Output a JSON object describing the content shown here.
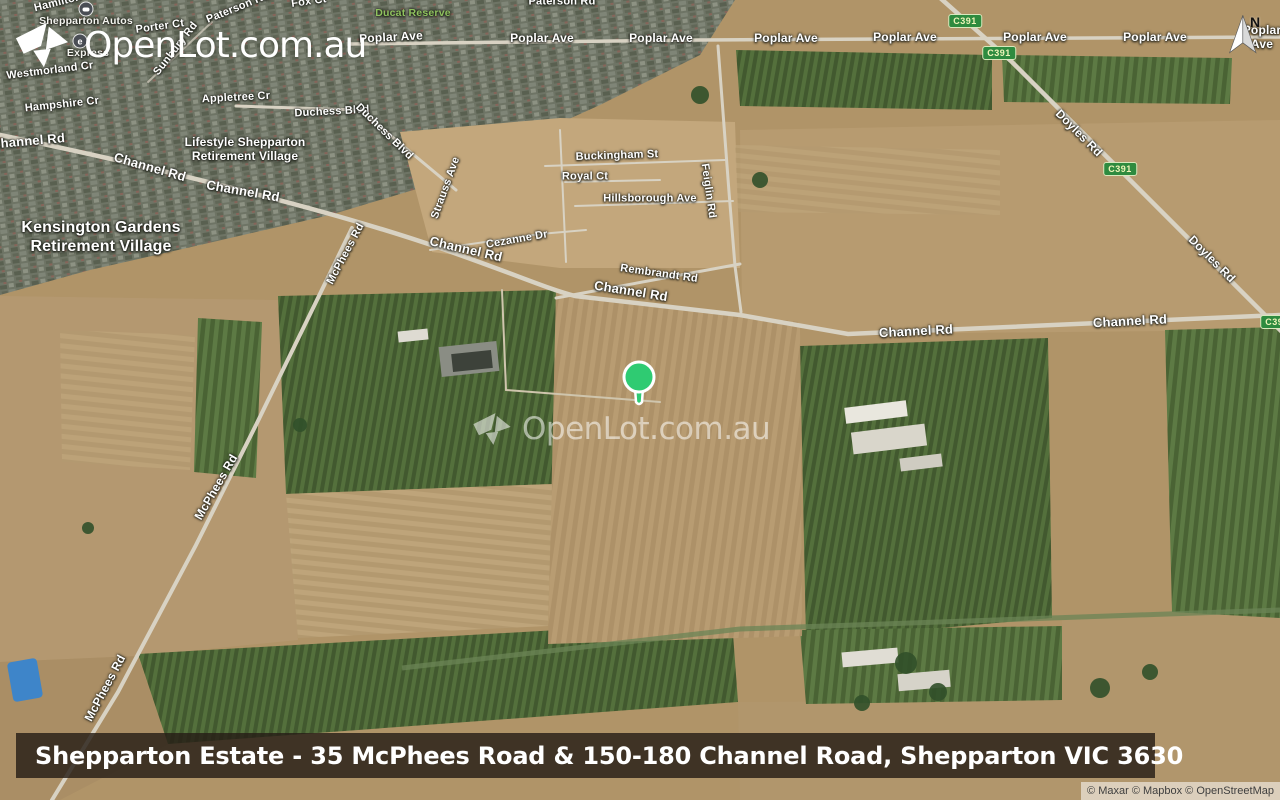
{
  "colors": {
    "marker": "#2fcb72",
    "shield_bg": "#2e8b3f",
    "shield_text": "#eef4b8",
    "park_label": "#8fc25e",
    "banner_bg": "rgba(38,29,22,0.82)"
  },
  "branding": {
    "logo_text": "OpenLot.com.au",
    "watermark_text": "OpenLot.com.au"
  },
  "compass": {
    "label": "N"
  },
  "banner": {
    "title": "Shepparton Estate - 35 McPhees Road & 150-180 Channel Road, Shepparton VIC 3630"
  },
  "attribution": {
    "text": "© Maxar © Mapbox © OpenStreetMap"
  },
  "map": {
    "labels": [
      {
        "t": "Hamilton",
        "x": 58,
        "y": 3,
        "r": -14,
        "s": 11
      },
      {
        "t": "Shepparton Autos",
        "x": 86,
        "y": 21,
        "r": 0,
        "s": 10.5,
        "k": "poi"
      },
      {
        "t": "Porter Ct",
        "x": 160,
        "y": 27,
        "r": -8,
        "s": 11
      },
      {
        "t": "Paterson Rd",
        "x": 238,
        "y": 8,
        "r": -22,
        "s": 11
      },
      {
        "t": "Fox Ct",
        "x": 309,
        "y": 2,
        "r": -8,
        "s": 11
      },
      {
        "t": "Ducat Reserve",
        "x": 413,
        "y": 13,
        "r": 0,
        "s": 10.5,
        "k": "park"
      },
      {
        "t": "Paterson Rd",
        "x": 562,
        "y": 2,
        "r": 0,
        "s": 11
      },
      {
        "t": "Express",
        "x": 88,
        "y": 53,
        "r": 0,
        "s": 10.5,
        "k": "poi"
      },
      {
        "t": "Sunbury Rd",
        "x": 176,
        "y": 49,
        "r": -52,
        "s": 11
      },
      {
        "t": "Westmorland Cr",
        "x": 50,
        "y": 71,
        "r": -7,
        "s": 11
      },
      {
        "t": "Hampshire Cr",
        "x": 62,
        "y": 105,
        "r": -6,
        "s": 11
      },
      {
        "t": "Appletree Cr",
        "x": 236,
        "y": 98,
        "r": -3,
        "s": 11
      },
      {
        "t": "Duchess Blvd",
        "x": 332,
        "y": 112,
        "r": -3,
        "s": 11
      },
      {
        "t": "Duchess Blvd",
        "x": 384,
        "y": 132,
        "r": 44,
        "s": 11
      },
      {
        "t": "Channel Rd",
        "x": 28,
        "y": 141,
        "r": -5,
        "s": 13
      },
      {
        "t": "Channel Rd",
        "x": 150,
        "y": 167,
        "r": 16,
        "s": 13
      },
      {
        "t": "Lifestyle Shepparton\nRetirement Village",
        "x": 245,
        "y": 149,
        "r": 0,
        "s": 12,
        "k": "place"
      },
      {
        "t": "Channel Rd",
        "x": 243,
        "y": 191,
        "r": 10,
        "s": 13
      },
      {
        "t": "Kensington Gardens\nRetirement Village",
        "x": 101,
        "y": 238,
        "r": 0,
        "s": 16,
        "k": "place"
      },
      {
        "t": "Strauss Ave",
        "x": 446,
        "y": 188,
        "r": -70,
        "s": 11
      },
      {
        "t": "Buckingham St",
        "x": 617,
        "y": 156,
        "r": -2,
        "s": 11
      },
      {
        "t": "Royal Ct",
        "x": 585,
        "y": 177,
        "r": 0,
        "s": 11
      },
      {
        "t": "Hillsborough Ave",
        "x": 650,
        "y": 199,
        "r": 0,
        "s": 11
      },
      {
        "t": "Feiglin Rd",
        "x": 708,
        "y": 191,
        "r": 82,
        "s": 11
      },
      {
        "t": "Cezanne Dr",
        "x": 517,
        "y": 240,
        "r": -10,
        "s": 11
      },
      {
        "t": "Channel Rd",
        "x": 466,
        "y": 249,
        "r": 13,
        "s": 13
      },
      {
        "t": "Rembrandt Rd",
        "x": 659,
        "y": 274,
        "r": 8,
        "s": 11
      },
      {
        "t": "Channel Rd",
        "x": 631,
        "y": 291,
        "r": 9,
        "s": 13
      },
      {
        "t": "McPhees Rd",
        "x": 346,
        "y": 254,
        "r": -62,
        "s": 11
      },
      {
        "t": "McPhees Rd",
        "x": 216,
        "y": 487,
        "r": -60,
        "s": 12
      },
      {
        "t": "McPhees Rd",
        "x": 105,
        "y": 688,
        "r": -62,
        "s": 12
      },
      {
        "t": "Channel Rd",
        "x": 916,
        "y": 331,
        "r": -3,
        "s": 13
      },
      {
        "t": "Channel Rd",
        "x": 1130,
        "y": 321,
        "r": -3,
        "s": 13
      },
      {
        "t": "Doyles Rd",
        "x": 1079,
        "y": 133,
        "r": 45,
        "s": 12
      },
      {
        "t": "Doyles Rd",
        "x": 1212,
        "y": 259,
        "r": 45,
        "s": 12
      },
      {
        "t": "Poplar Ave",
        "x": 391,
        "y": 37,
        "r": -3,
        "s": 12
      },
      {
        "t": "Poplar Ave",
        "x": 542,
        "y": 38,
        "r": 0,
        "s": 12
      },
      {
        "t": "Poplar Ave",
        "x": 661,
        "y": 38,
        "r": 0,
        "s": 12
      },
      {
        "t": "Poplar Ave",
        "x": 786,
        "y": 38,
        "r": 0,
        "s": 12
      },
      {
        "t": "Poplar Ave",
        "x": 905,
        "y": 37,
        "r": 0,
        "s": 12
      },
      {
        "t": "Poplar Ave",
        "x": 1035,
        "y": 37,
        "r": 0,
        "s": 12
      },
      {
        "t": "Poplar Ave",
        "x": 1155,
        "y": 37,
        "r": 0,
        "s": 12
      },
      {
        "t": "Poplar Ave",
        "x": 1262,
        "y": 37,
        "r": 0,
        "s": 12
      }
    ],
    "shields": [
      {
        "t": "C391",
        "x": 965,
        "y": 21
      },
      {
        "t": "C391",
        "x": 999,
        "y": 53
      },
      {
        "t": "C391",
        "x": 1120,
        "y": 169
      },
      {
        "t": "C391",
        "x": 1277,
        "y": 322
      }
    ],
    "pois": [
      {
        "icon": "car",
        "x": 86,
        "y": 9
      },
      {
        "icon": "e",
        "x": 80,
        "y": 41,
        "t": "e"
      }
    ]
  }
}
